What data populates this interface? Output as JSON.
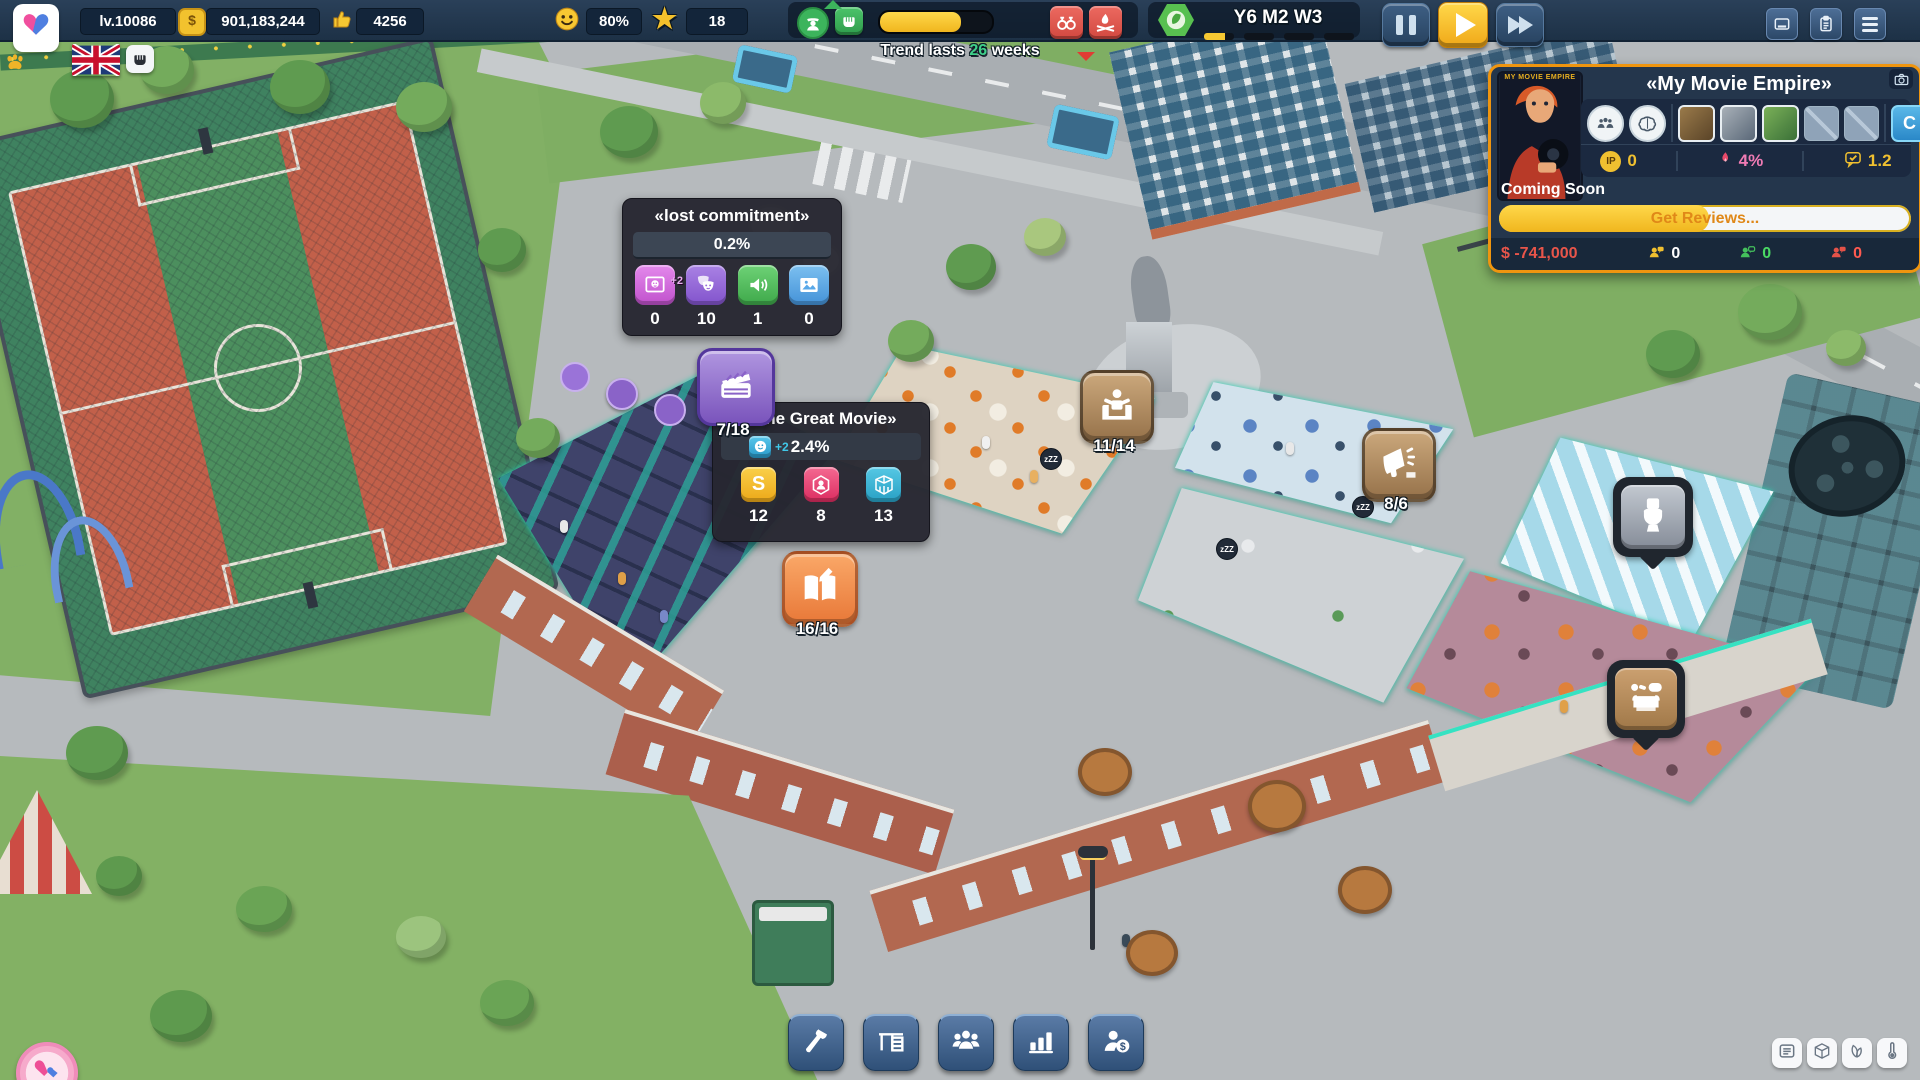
{
  "top_bar": {
    "level": "lv.10086",
    "money": "901,183,244",
    "likes": "4256",
    "happiness": "80%",
    "stars": "18",
    "coin_glyph": "$",
    "trend": {
      "prefix": "Trend lasts",
      "weeks": "26",
      "suffix": "weeks",
      "progress_percent": 72
    },
    "date": {
      "label": "Y6 M2 W3",
      "week_progress_percent": 70
    }
  },
  "movie_panel": {
    "title": "《My Movie Empire》",
    "poster_caption": "MY MOVIE EMPIRE",
    "slot_button": "C",
    "ip_glyph": "IP",
    "ip_value": "0",
    "heat_value": "4%",
    "rating_value": "1.2",
    "status": "Coming Soon",
    "progress_label": "Get Reviews...",
    "progress_percent": 51,
    "cost": "$ -741,000",
    "viewers": [
      {
        "name": "interested",
        "value": "0"
      },
      {
        "name": "positive",
        "value": "0"
      },
      {
        "name": "negative",
        "value": "0"
      }
    ]
  },
  "lost_tooltip": {
    "title": "《lost commitment》",
    "percent": "0.2%",
    "stats": [
      {
        "icon": "photo-mask-icon",
        "badge": "+2",
        "value": "0"
      },
      {
        "icon": "theater-masks-icon",
        "value": "10"
      },
      {
        "icon": "speaker-icon",
        "value": "1"
      },
      {
        "icon": "picture-icon",
        "value": "0"
      }
    ]
  },
  "movie_tooltip": {
    "title": "《The Great Movie》",
    "buff_badge": "+2",
    "percent": "2.4%",
    "stats": [
      {
        "icon": "script-icon",
        "glyph": "S",
        "value": "12"
      },
      {
        "icon": "actor-icon",
        "value": "8"
      },
      {
        "icon": "studio-icon",
        "value": "13"
      }
    ]
  },
  "production_badge": {
    "count": "7/18"
  },
  "rooms": {
    "lounge": {
      "count": "11/14"
    },
    "marketing": {
      "count": "8/6"
    },
    "writing": {
      "count": "16/16"
    }
  },
  "scene": {
    "sleep_bubble": "zZZ"
  }
}
